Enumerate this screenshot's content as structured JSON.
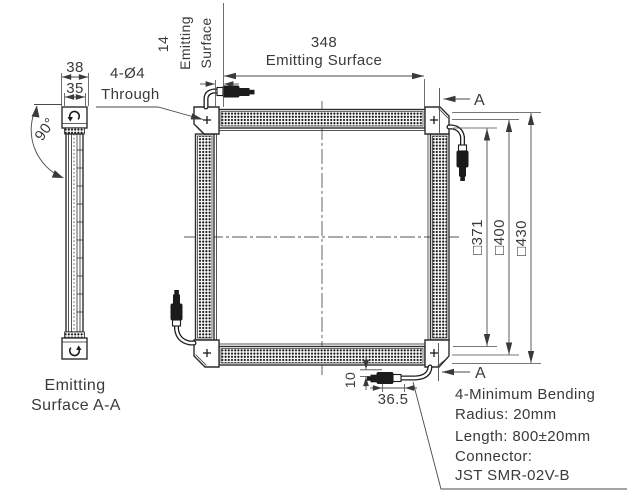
{
  "drawing": {
    "side_view": {
      "dim_width_outer": "38",
      "dim_width_inner": "35",
      "angle": "90°",
      "caption_1": "Emitting",
      "caption_2": "Surface A-A"
    },
    "front_view": {
      "dim_emitting_width": "348",
      "dim_emitting_width_label": "Emitting Surface",
      "dim_edge": "14",
      "dim_edge_label_1": "Emitting",
      "dim_edge_label_2": "Surface",
      "holes_label_1": "4-Ø4",
      "holes_label_2": "Through",
      "section_marker": "A",
      "dim_inner": "□371",
      "dim_frame": "□400",
      "dim_outer": "□430",
      "dim_cable_offset": "10",
      "dim_connector_length": "36.5"
    },
    "cable_note": {
      "line_1": "4-Minimum Bending",
      "line_2": "Radius: 20mm",
      "line_3": "Length: 800±20mm",
      "line_4": "Connector:",
      "line_5": "JST SMR-02V-B"
    }
  },
  "colors": {
    "line": "#2d2d2d",
    "text": "#3a3a3a",
    "background": "#ffffff"
  }
}
